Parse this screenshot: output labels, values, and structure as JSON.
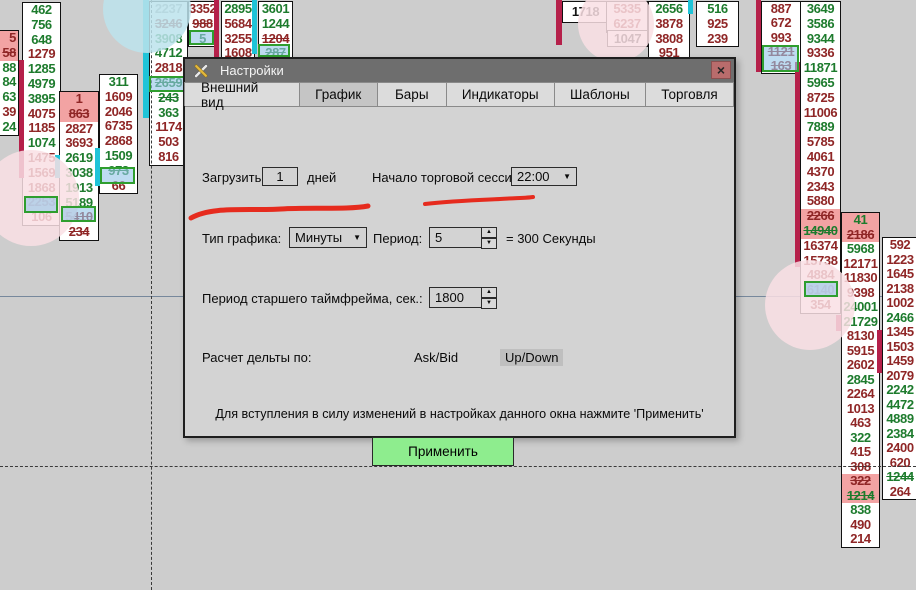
{
  "dialog": {
    "title": "Настройки",
    "close_label": "×",
    "tabs": [
      {
        "label": "Внешний вид"
      },
      {
        "label": "График"
      },
      {
        "label": "Бары"
      },
      {
        "label": "Индикаторы"
      },
      {
        "label": "Шаблоны"
      },
      {
        "label": "Торговля"
      }
    ],
    "active_tab": 1,
    "load_label": "Загрузить",
    "load_value": "1",
    "days_label": "дней",
    "session_label": "Начало торговой сессии:",
    "session_value": "22:00",
    "type_label": "Тип графика:",
    "type_value": "Минуты",
    "period_label": "Период:",
    "period_value": "5",
    "equals_label": "= 300 Секунды",
    "htf_label": "Период старшего таймфрейма, сек.:",
    "htf_value": "1800",
    "delta_label": "Расчет дельты по:",
    "askbid_label": "Ask/Bid",
    "updown_label": "Up/Down",
    "note": "Для вступления в силу изменений в настройках данного окна нажмите 'Применить'",
    "apply_label": "Применить",
    "spin_up": "▲",
    "spin_down": "▼",
    "dd_arrow": "▼"
  },
  "colors": {
    "up_text": "#1d7b2d",
    "down_text": "#8f2626",
    "black_text": "#141414",
    "faded_text": "#9b9b9b",
    "pink_highlight": "#f2a3a3",
    "cyan_bar": "#1fc4d8",
    "crimson_bar": "#b5204a",
    "select_fill": "rgba(150,199,232,0.62)",
    "select_border": "#2f9e2f",
    "annotation_red": "#e62b1e",
    "apply_green": "#8eed8e"
  },
  "columns": [
    {
      "x": -27,
      "y": 30,
      "w": 44,
      "rh": 14.8,
      "align": "right",
      "cells": [
        [
          "5",
          "r",
          "p"
        ],
        [
          "58",
          "r",
          "ps"
        ],
        [
          "88",
          "g"
        ],
        [
          "84",
          "g"
        ],
        [
          "63",
          "g"
        ],
        [
          "39",
          "r"
        ],
        [
          "24",
          "g"
        ]
      ]
    },
    {
      "x": 22,
      "y": 2,
      "w": 37,
      "rh": 14.8,
      "cells": [
        [
          "462",
          "g"
        ],
        [
          "756",
          "g"
        ],
        [
          "648",
          "g"
        ],
        [
          "1279",
          "r"
        ],
        [
          "1285",
          "g"
        ],
        [
          "4979",
          "g"
        ],
        [
          "3895",
          "g"
        ],
        [
          "4075",
          "r"
        ],
        [
          "1185",
          "r"
        ],
        [
          "1074",
          "g"
        ],
        [
          "1475",
          "r"
        ],
        [
          "1569",
          "r"
        ],
        [
          "1868",
          "r"
        ],
        [
          "2253",
          "r"
        ],
        [
          "106",
          "r"
        ]
      ]
    },
    {
      "x": 59,
      "y": 91,
      "w": 38,
      "rh": 14.8,
      "cells": [
        [
          "1",
          "r",
          "p"
        ],
        [
          "863",
          "r",
          "ps"
        ],
        [
          "2827",
          "r"
        ],
        [
          "3693",
          "r"
        ],
        [
          "2619",
          "g"
        ],
        [
          "3038",
          "g"
        ],
        [
          "1913",
          "g"
        ],
        [
          "5189",
          "g"
        ],
        [
          "5410",
          "r",
          "s"
        ],
        [
          "234",
          "r",
          "s"
        ]
      ]
    },
    {
      "x": 99,
      "y": 74,
      "w": 37,
      "rh": 14.8,
      "cells": [
        [
          "311",
          "g"
        ],
        [
          "1609",
          "r"
        ],
        [
          "2046",
          "r"
        ],
        [
          "6735",
          "r"
        ],
        [
          "2868",
          "r"
        ],
        [
          "1509",
          "g"
        ],
        [
          "973",
          "g",
          "s"
        ],
        [
          "66",
          "r"
        ]
      ]
    },
    {
      "x": 149,
      "y": 1,
      "w": 37,
      "rh": 14.8,
      "cells": [
        [
          "2237",
          "y"
        ],
        [
          "3246",
          "r",
          "s"
        ],
        [
          "3908",
          "g"
        ],
        [
          "4712",
          "g"
        ],
        [
          "2818",
          "r"
        ],
        [
          "2659",
          "g",
          "s"
        ],
        [
          "243",
          "g",
          "s"
        ],
        [
          "363",
          "g"
        ],
        [
          "1174",
          "r"
        ],
        [
          "503",
          "r"
        ],
        [
          "816",
          "r"
        ]
      ]
    },
    {
      "x": 188,
      "y": 1,
      "w": 27,
      "rh": 14.8,
      "cells": [
        [
          "3352",
          "r"
        ],
        [
          "988",
          "r",
          "s"
        ],
        [
          "5",
          "g"
        ]
      ]
    },
    {
      "x": 221,
      "y": 1,
      "w": 32,
      "rh": 14.8,
      "cells": [
        [
          "2895",
          "g"
        ],
        [
          "5684",
          "r"
        ],
        [
          "3255",
          "r"
        ],
        [
          "1608",
          "r"
        ]
      ]
    },
    {
      "x": 258,
      "y": 1,
      "w": 33,
      "rh": 14.8,
      "cells": [
        [
          "3601",
          "g"
        ],
        [
          "1244",
          "g"
        ],
        [
          "1204",
          "r",
          "s"
        ],
        [
          "287",
          "g",
          "s"
        ]
      ]
    },
    {
      "x": 562,
      "y": 1,
      "w": 45,
      "rh": 20,
      "cells": [
        [
          "1718",
          "k"
        ]
      ]
    },
    {
      "x": 606,
      "y": 1,
      "w": 40,
      "rh": 14.8,
      "cells": [
        [
          "5335",
          "r"
        ],
        [
          "6237",
          "r"
        ]
      ]
    },
    {
      "x": 607,
      "y": 30,
      "w": 39,
      "rh": 15,
      "cells": [
        [
          "1047",
          "k"
        ]
      ]
    },
    {
      "x": 648,
      "y": 1,
      "w": 40,
      "rh": 14.8,
      "cells": [
        [
          "2656",
          "g"
        ],
        [
          "3878",
          "r"
        ],
        [
          "3808",
          "r"
        ],
        [
          "951",
          "r"
        ]
      ]
    },
    {
      "x": 696,
      "y": 1,
      "w": 41,
      "rh": 14.8,
      "cells": [
        [
          "516",
          "g"
        ],
        [
          "925",
          "r"
        ],
        [
          "239",
          "r"
        ]
      ]
    },
    {
      "x": 761,
      "y": 1,
      "w": 38,
      "rh": 14.3,
      "cells": [
        [
          "887",
          "r"
        ],
        [
          "672",
          "r"
        ],
        [
          "993",
          "r"
        ],
        [
          "1121",
          "r",
          "s"
        ],
        [
          "163",
          "r",
          "s"
        ]
      ]
    },
    {
      "x": 800,
      "y": 1,
      "w": 39,
      "rh": 14.8,
      "cells": [
        [
          "3649",
          "g"
        ],
        [
          "3586",
          "g"
        ],
        [
          "9344",
          "g"
        ],
        [
          "9336",
          "r"
        ],
        [
          "11871",
          "g"
        ],
        [
          "5965",
          "g"
        ],
        [
          "8725",
          "r"
        ],
        [
          "11006",
          "r"
        ],
        [
          "7889",
          "g"
        ],
        [
          "5785",
          "r"
        ],
        [
          "4061",
          "r"
        ],
        [
          "4370",
          "r"
        ],
        [
          "2343",
          "r"
        ],
        [
          "5880",
          "r"
        ],
        [
          "2266",
          "r",
          "ps"
        ],
        [
          "14940",
          "g",
          "ps"
        ],
        [
          "16374",
          "r"
        ],
        [
          "15738",
          "r"
        ],
        [
          "4884",
          "r"
        ],
        [
          "6140",
          "r"
        ],
        [
          "354",
          "r"
        ]
      ]
    },
    {
      "x": 841,
      "y": 212,
      "w": 37,
      "rh": 14.5,
      "cells": [
        [
          "41",
          "g",
          "p"
        ],
        [
          "2186",
          "r",
          "ps"
        ],
        [
          "5968",
          "g"
        ],
        [
          "12171",
          "r"
        ],
        [
          "11830",
          "r"
        ],
        [
          "9398",
          "r"
        ],
        [
          "24001",
          "g"
        ],
        [
          "21729",
          "g"
        ],
        [
          "8130",
          "r"
        ],
        [
          "5915",
          "r"
        ],
        [
          "2602",
          "r"
        ],
        [
          "2845",
          "g"
        ],
        [
          "2264",
          "r"
        ],
        [
          "1013",
          "r"
        ],
        [
          "463",
          "r"
        ],
        [
          "322",
          "g"
        ],
        [
          "415",
          "r"
        ],
        [
          "308",
          "r",
          "s"
        ],
        [
          "322",
          "r",
          "ps"
        ],
        [
          "1214",
          "g",
          "ps"
        ],
        [
          "838",
          "g"
        ],
        [
          "490",
          "r"
        ],
        [
          "214",
          "r"
        ]
      ]
    },
    {
      "x": 882,
      "y": 237,
      "w": 34,
      "rh": 14.5,
      "cells": [
        [
          "592",
          "r"
        ],
        [
          "1223",
          "r"
        ],
        [
          "1645",
          "r"
        ],
        [
          "2138",
          "r"
        ],
        [
          "1002",
          "r"
        ],
        [
          "2466",
          "g"
        ],
        [
          "1345",
          "r"
        ],
        [
          "1503",
          "r"
        ],
        [
          "1459",
          "r"
        ],
        [
          "2079",
          "r"
        ],
        [
          "2242",
          "g"
        ],
        [
          "4472",
          "g"
        ],
        [
          "4889",
          "g"
        ],
        [
          "2384",
          "g"
        ],
        [
          "2400",
          "r"
        ],
        [
          "620",
          "r"
        ],
        [
          "1244",
          "g",
          "s"
        ],
        [
          "264",
          "r"
        ]
      ]
    }
  ],
  "bars": [
    {
      "x": 19,
      "y": 60,
      "w": 5,
      "h": 118,
      "c": "cr"
    },
    {
      "x": 55,
      "y": 155,
      "w": 5,
      "h": 23,
      "c": "cy"
    },
    {
      "x": 95,
      "y": 148,
      "w": 5,
      "h": 38,
      "c": "cy"
    },
    {
      "x": 143,
      "y": 0,
      "w": 6,
      "h": 118,
      "c": "cy"
    },
    {
      "x": 214,
      "y": 0,
      "w": 5,
      "h": 57,
      "c": "cr"
    },
    {
      "x": 252,
      "y": 0,
      "w": 5,
      "h": 54,
      "c": "cy"
    },
    {
      "x": 556,
      "y": 0,
      "w": 6,
      "h": 45,
      "c": "cr"
    },
    {
      "x": 688,
      "y": 0,
      "w": 5,
      "h": 14,
      "c": "cy"
    },
    {
      "x": 756,
      "y": 0,
      "w": 5,
      "h": 72,
      "c": "cr"
    },
    {
      "x": 795,
      "y": 62,
      "w": 5,
      "h": 205,
      "c": "cr"
    },
    {
      "x": 836,
      "y": 315,
      "w": 5,
      "h": 16,
      "c": "cr"
    },
    {
      "x": 877,
      "y": 330,
      "w": 5,
      "h": 43,
      "c": "cr"
    }
  ],
  "circles": [
    {
      "cx": 147,
      "cy": 9,
      "r": 44,
      "fill": "rgba(188,227,236,0.85)"
    },
    {
      "cx": 31,
      "cy": 198,
      "r": 48,
      "fill": "rgba(249,223,228,0.85)"
    },
    {
      "cx": 616,
      "cy": 24,
      "r": 38,
      "fill": "rgba(249,223,228,0.85)"
    },
    {
      "cx": 810,
      "cy": 305,
      "r": 45,
      "fill": "rgba(249,223,228,0.85)"
    }
  ],
  "select_boxes": [
    {
      "x": 24,
      "y": 196,
      "w": 34,
      "h": 17
    },
    {
      "x": 61,
      "y": 206,
      "w": 35,
      "h": 16
    },
    {
      "x": 100,
      "y": 167,
      "w": 35,
      "h": 17
    },
    {
      "x": 149,
      "y": 76,
      "w": 36,
      "h": 16
    },
    {
      "x": 189,
      "y": 30,
      "w": 25,
      "h": 15
    },
    {
      "x": 258,
      "y": 44,
      "w": 32,
      "h": 13
    },
    {
      "x": 762,
      "y": 45,
      "w": 37,
      "h": 27
    },
    {
      "x": 804,
      "y": 281,
      "w": 34,
      "h": 16
    }
  ],
  "lines": {
    "solid_horizontal_y": 296,
    "dashed_vertical_x": 151,
    "dashed_horizontal_y": 466
  },
  "annotations": {
    "paths": [
      "M191 218 C 212 206, 246 211, 281 209 C 311 207, 347 210, 368 206",
      "M425 204 C 450 201, 478 200, 500 199 C 515 198, 528 198, 533 197"
    ],
    "stroke": "#e62b1e"
  }
}
